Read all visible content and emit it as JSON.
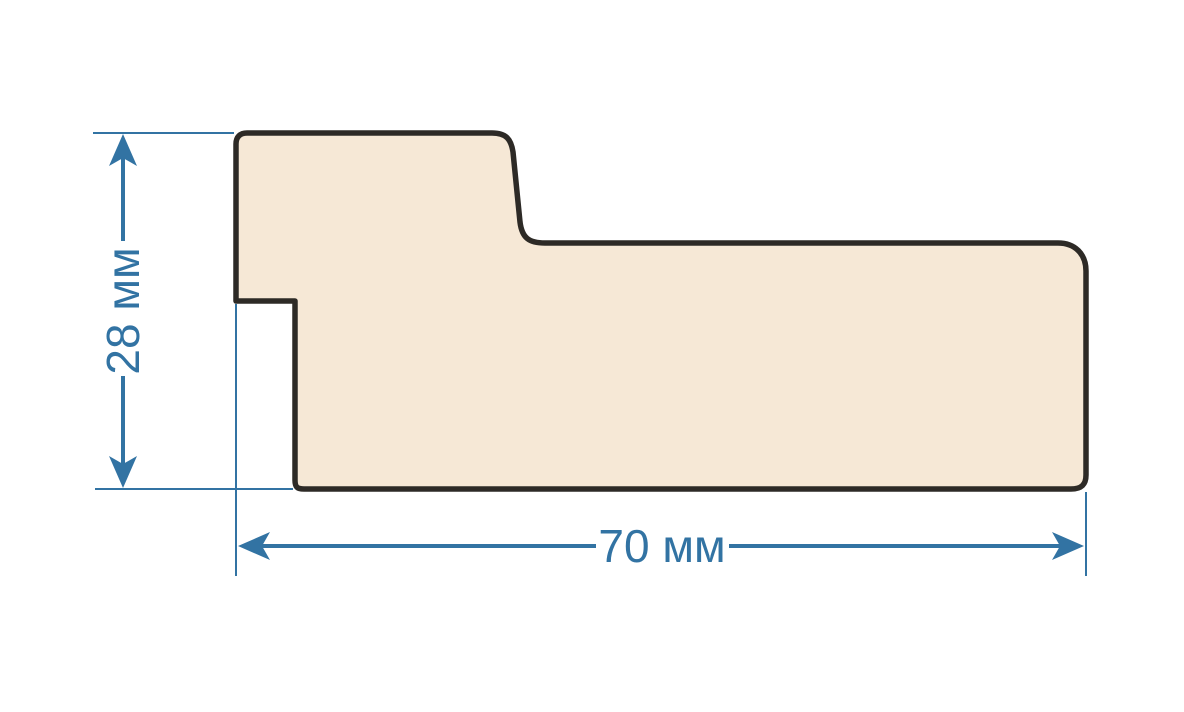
{
  "diagram": {
    "background_color": "#ffffff",
    "profile": {
      "name": "moulding-profile-cross-section",
      "fill_color": "#f6e8d6",
      "outline_color": "#2d2a26"
    },
    "dimensions": {
      "color": "#3273a3",
      "height": {
        "label": "28 мм",
        "value": 28,
        "unit": "мм",
        "orientation": "vertical"
      },
      "width": {
        "label": "70 мм",
        "value": 70,
        "unit": "мм",
        "orientation": "horizontal"
      }
    }
  }
}
